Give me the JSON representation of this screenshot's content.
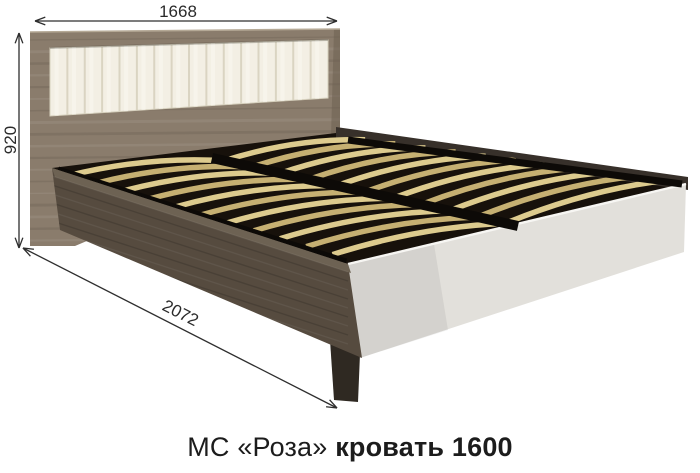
{
  "diagram": {
    "title_hint": "furniture dimension drawing of a double bed",
    "dimensions": {
      "width": {
        "label": "1668"
      },
      "height": {
        "label": "920"
      },
      "length": {
        "label": "2072"
      }
    },
    "caption": {
      "series": "МС «Роза»",
      "product": "кровать 1600"
    },
    "illustration": {
      "pleat_count": 16,
      "slats_per_side": 11,
      "colors": {
        "headboard_wood": "#8a7c6c",
        "headboard_wood_dark": "#6e6152",
        "cushion": "#f3efe4",
        "cushion_shadow": "#d6d0bd",
        "cushion_highlight": "#fbf9f2",
        "side_rail_wood": "#564b3f",
        "side_rail_top": "#6d6253",
        "back_rail_wood": "#37302a",
        "slat": "#ddcb8e",
        "slat_dark": "#c6b072",
        "slat_gap": "#17110b",
        "black_rail": "#0d0a07",
        "foot_panel": "#e2e0db",
        "foot_panel_edge": "#f7f6f3",
        "foot_leg": "#2f2922",
        "dimension_line": "#2e2e2e",
        "caption_text": "#1c1c1c"
      }
    }
  }
}
